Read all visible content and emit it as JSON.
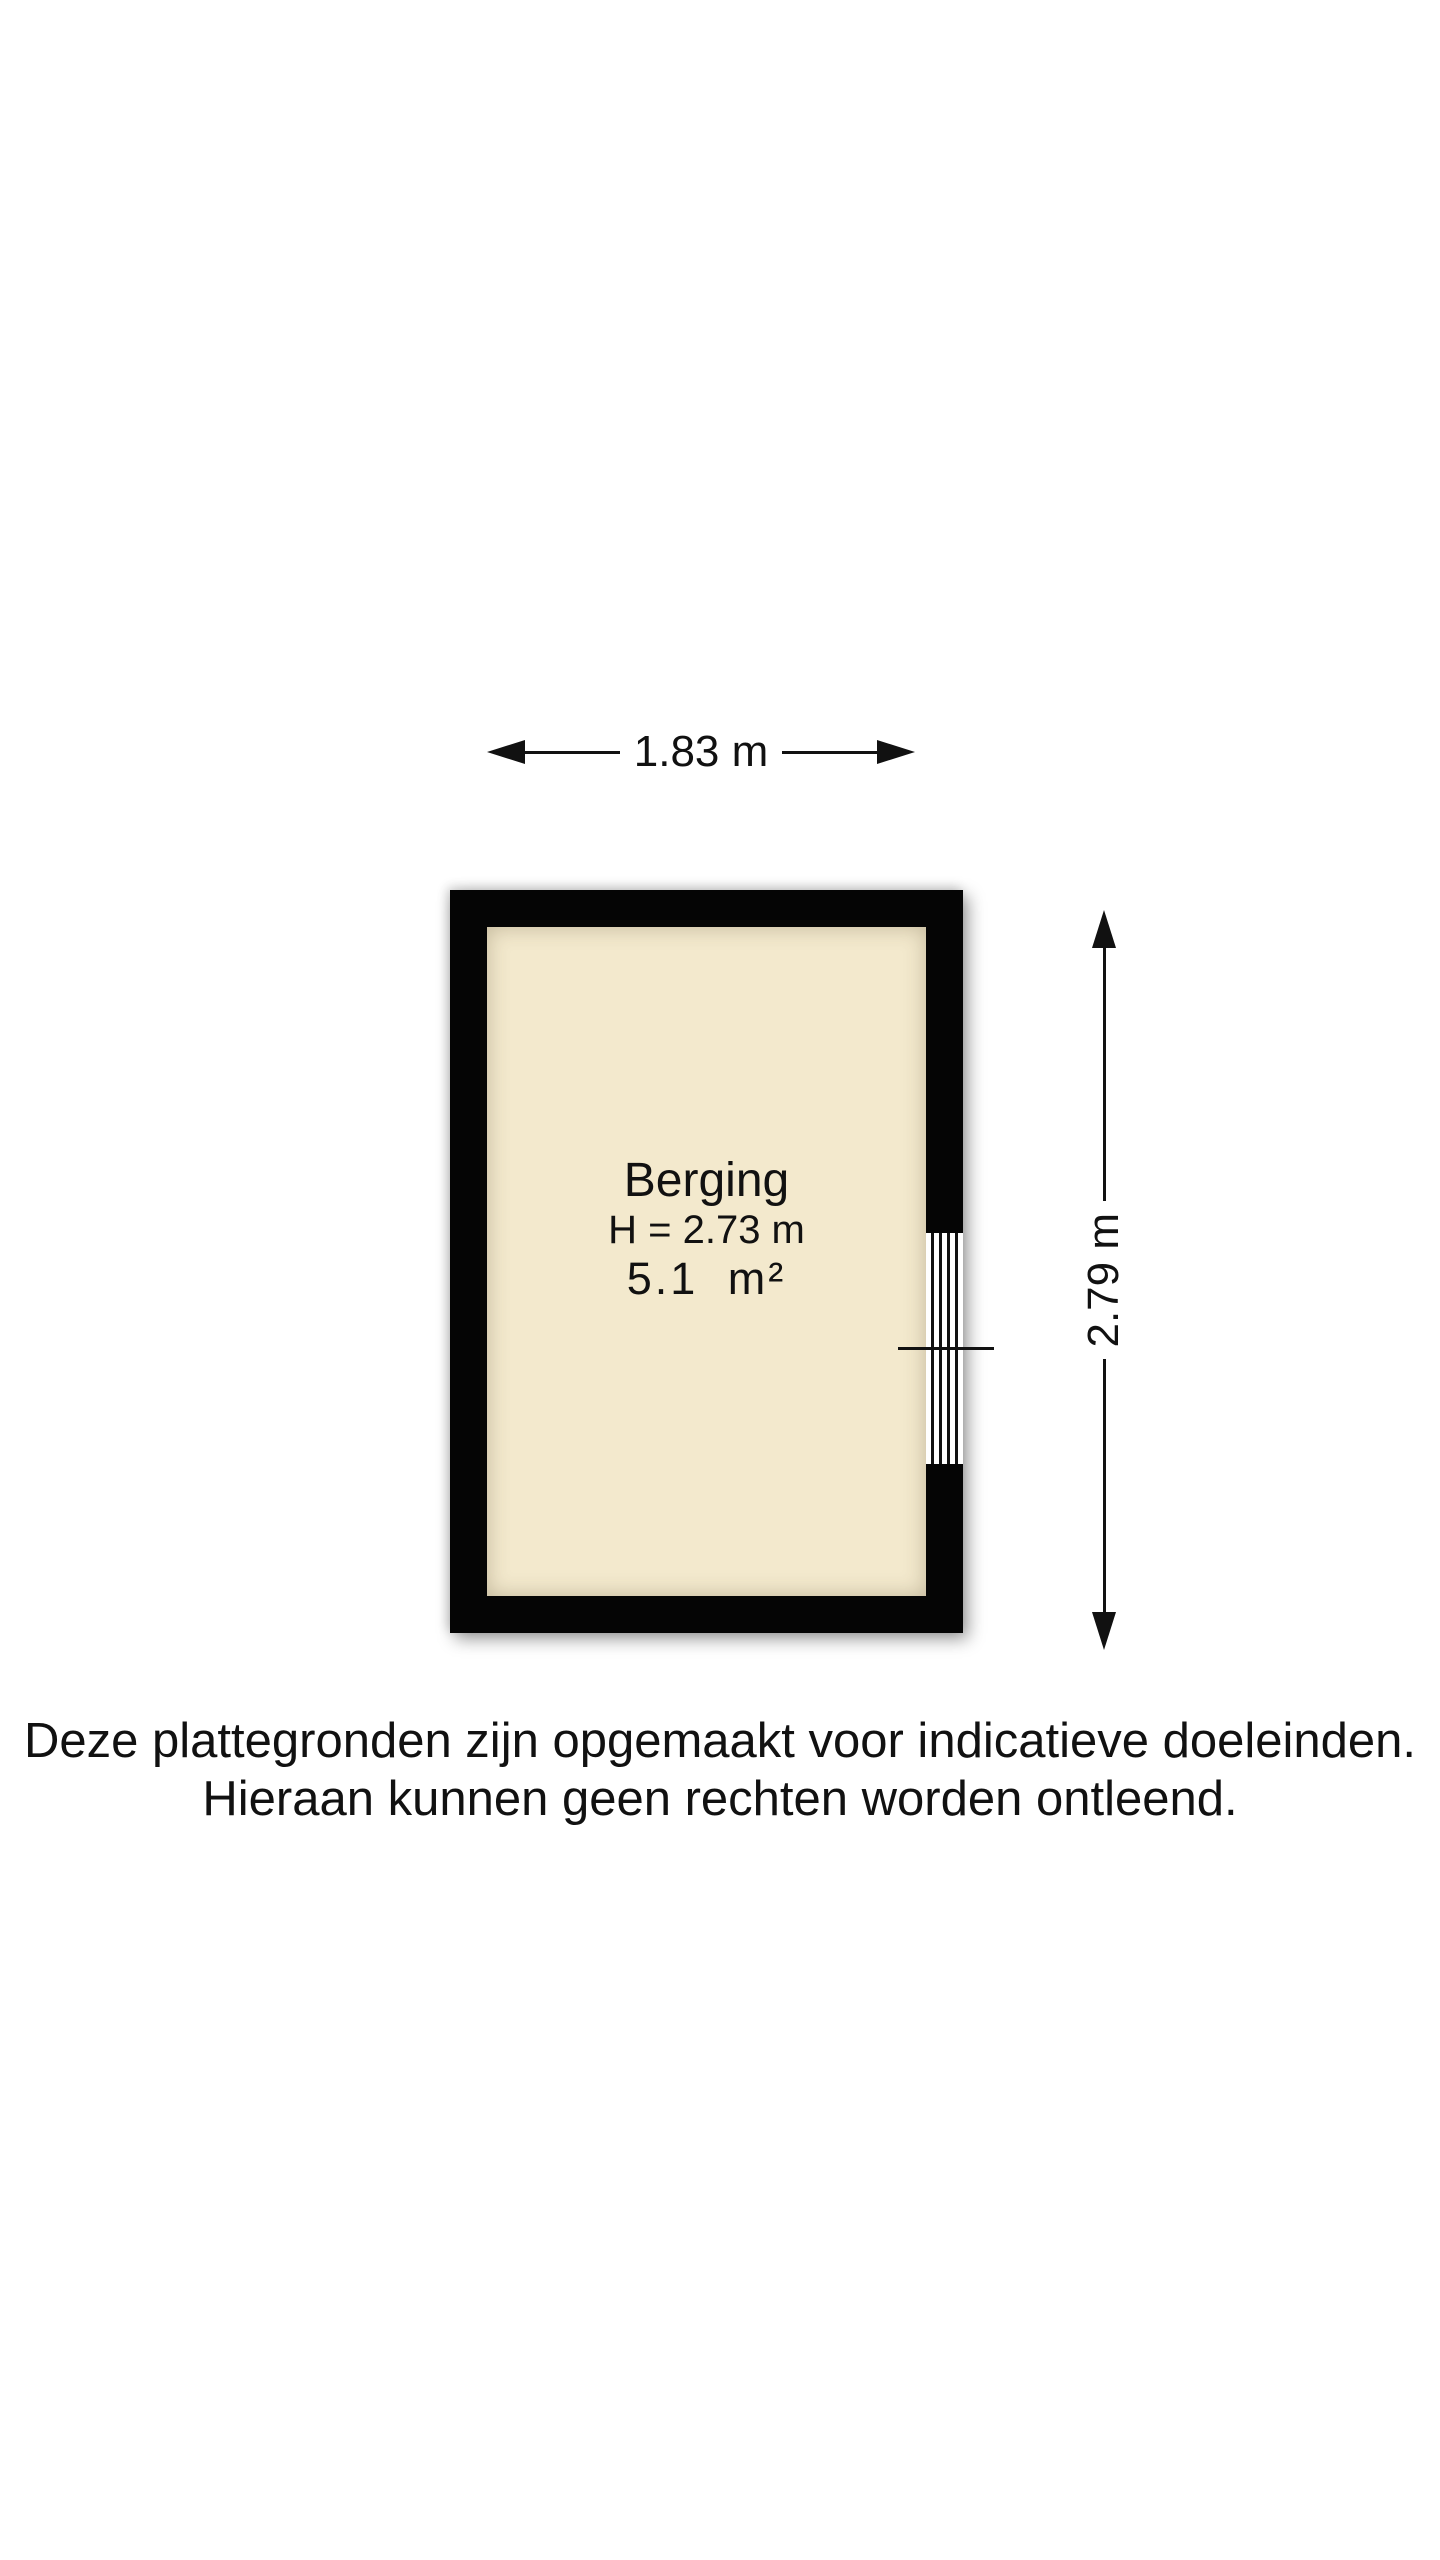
{
  "floorplan": {
    "room": {
      "name": "Berging",
      "ceiling_height": "H = 2.73 m",
      "area": "5.1 m²"
    },
    "dimensions": {
      "width_label": "1.83 m",
      "height_label": "2.79 m"
    },
    "colors": {
      "wall": "#050505",
      "floor": "#f3e9cd",
      "background": "#ffffff",
      "text": "#111111"
    }
  },
  "disclaimer": {
    "line1": "Deze plattegronden zijn opgemaakt voor indicatieve doeleinden.",
    "line2": "Hieraan kunnen geen rechten worden ontleend."
  }
}
